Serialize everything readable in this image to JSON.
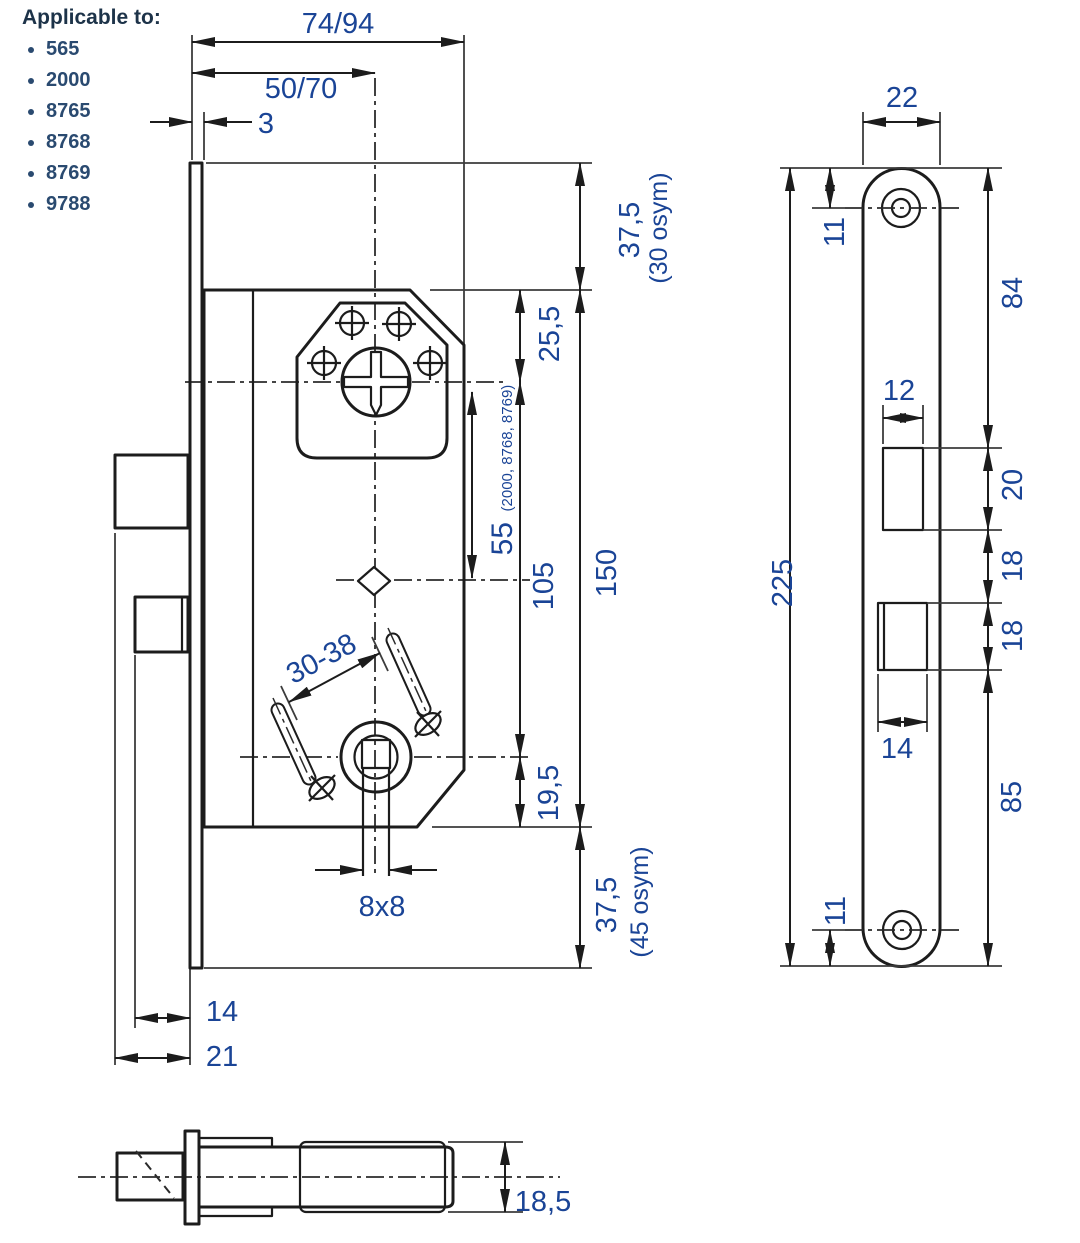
{
  "header": {
    "title": "Applicable to:",
    "models": [
      "565",
      "2000",
      "8765",
      "8768",
      "8769",
      "9788"
    ]
  },
  "front_view": {
    "case_width": "74/94",
    "backset": "50/70",
    "faceplate_thickness": "3",
    "top_margin": "37,5",
    "top_margin_note": "(30 osym)",
    "cylinder_from_case_top": "25,5",
    "cylinder_to_hub": "55",
    "cylinder_to_hub_note": "(2000, 8768, 8769)",
    "cylinder_to_follower": "105",
    "case_height": "150",
    "follower_to_case_bottom": "19,5",
    "bottom_margin": "37,5",
    "bottom_margin_note": "(45 osym)",
    "adjust_range": "30-38",
    "spindle_size": "8x8",
    "deadbolt_throw": "14",
    "latch_throw": "21"
  },
  "faceplate_view": {
    "plate_width": "22",
    "top_screw_offset": "11",
    "top_to_latch": "84",
    "latch_cutout_width": "12",
    "latch_cutout_height": "20",
    "latch_to_bolt_gap": "18",
    "bolt_cutout_height": "18",
    "bolt_cutout_width": "14",
    "bolt_to_bottom": "85",
    "bottom_screw_offset": "11",
    "plate_length": "225"
  },
  "side_view": {
    "case_thickness": "18,5"
  },
  "colors": {
    "dimension_text": "#1a4496",
    "line": "#1c1c1c",
    "header_text": "#1d3349"
  }
}
